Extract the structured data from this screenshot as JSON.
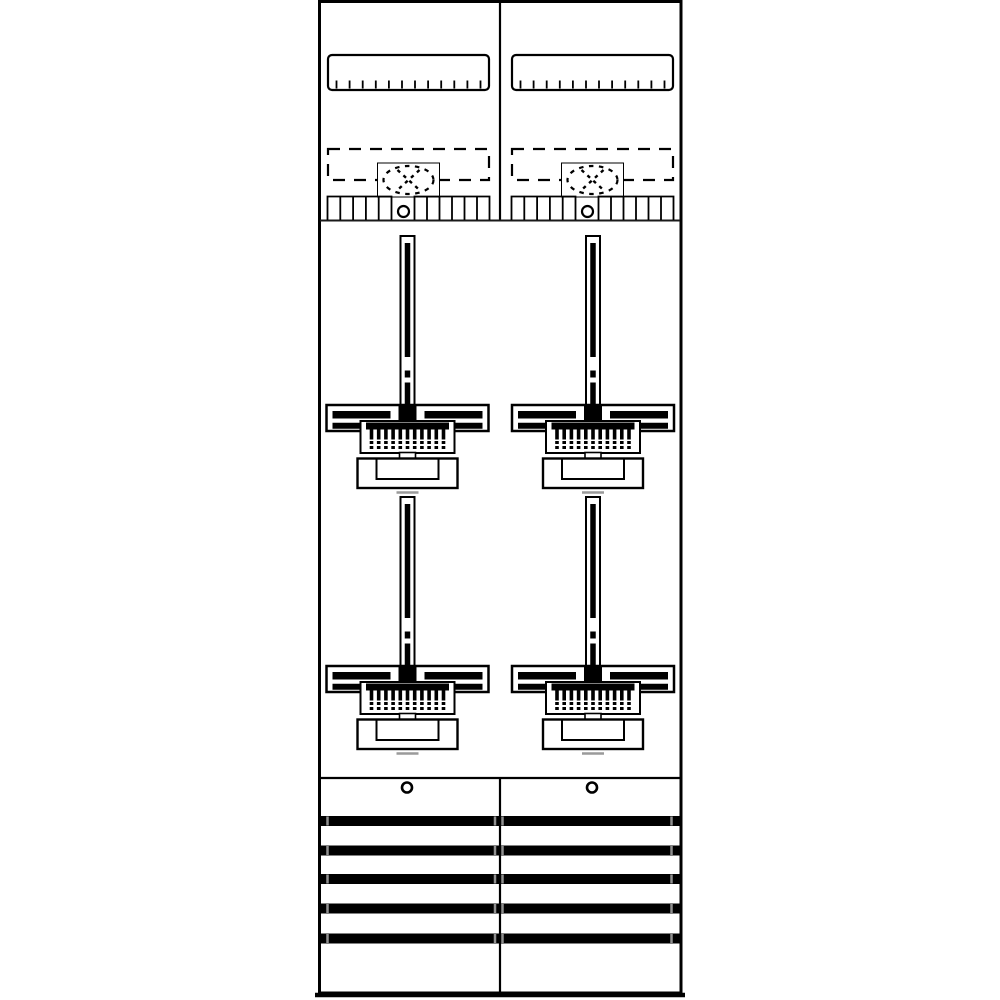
{
  "meta": {
    "description": "Technical line drawing of a two-column electricity meter board",
    "text_content": "none (drawing only)"
  },
  "palette": {
    "line": "#000000",
    "background": "#ffffff",
    "muted": "#909090",
    "soft": "#9a9a9a"
  },
  "board": {
    "columns": 2,
    "top_section": {
      "din_rails": 2,
      "din_rail_ticks_per_rail": 12,
      "knockout_zones": 2,
      "knockout_symbol": "dashed circle with X",
      "terminal_combs": 2,
      "comb_cells_left_group": 5,
      "comb_cells_right_group": 6,
      "comb_screws": 2
    },
    "middle_section": {
      "meter_units": 4,
      "rows": 2,
      "unit_parts": {
        "mounting_rail": 1,
        "cross_bracket": 1,
        "bracket_dots": 2,
        "terminal_block_teeth": 11,
        "terminal_block_dot_rows": 2,
        "meter_base": 1
      }
    },
    "bottom_section": {
      "screws": 2,
      "busbars": 5,
      "busbar_clips_per_bar": 4
    }
  }
}
